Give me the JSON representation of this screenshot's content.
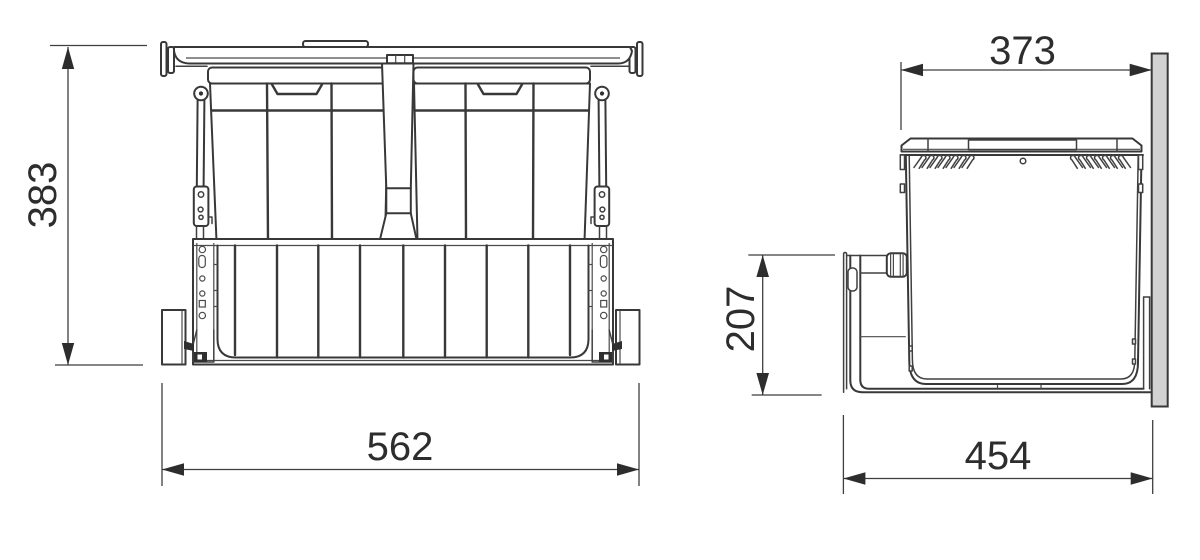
{
  "colors": {
    "background": "#ffffff",
    "line": "#383838",
    "dim_line": "#3f3f3f",
    "text": "#2d2d2d",
    "panel_fill": "#d2d2d2"
  },
  "front_view": {
    "height_mm": "383",
    "width_mm": "562"
  },
  "side_view": {
    "top_width_mm": "373",
    "rear_height_mm": "207",
    "depth_mm": "454"
  }
}
